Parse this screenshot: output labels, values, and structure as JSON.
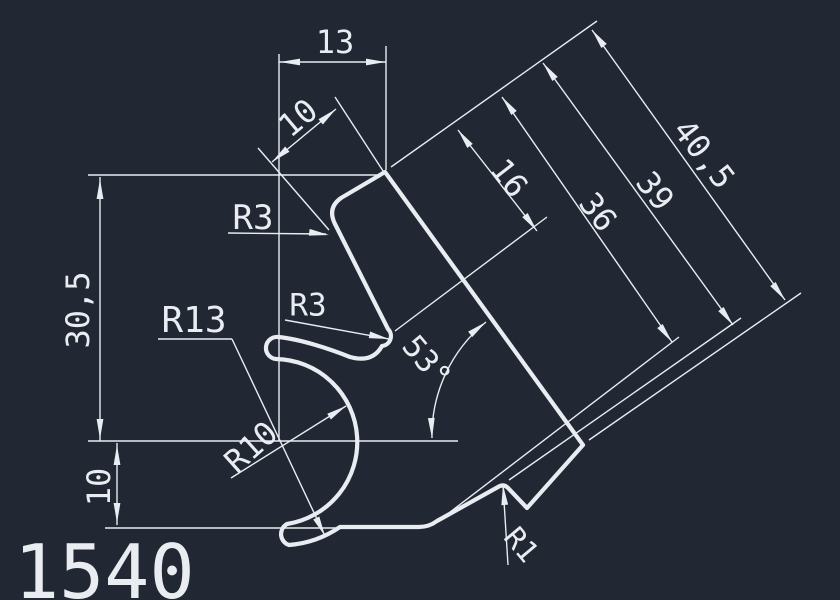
{
  "window": {
    "type": "cad-drawing-viewport",
    "description": "AutoCAD-style technical drawing of profile cross-section on dark model-space background"
  },
  "colors": {
    "background": "#212733",
    "line": "#e9edf2"
  },
  "part": {
    "number": "1540"
  },
  "dimensions": {
    "dim_13": {
      "label": "13"
    },
    "dim_10_top": {
      "label": "10"
    },
    "dim_30_5": {
      "label": "30,5"
    },
    "dim_10_left": {
      "label": "10"
    },
    "dim_16": {
      "label": "16"
    },
    "dim_36": {
      "label": "36"
    },
    "dim_39": {
      "label": "39"
    },
    "dim_40_5": {
      "label": "40,5"
    },
    "angle_53": {
      "label": "53°"
    },
    "radius_r13": {
      "label": "R13"
    },
    "radius_r10": {
      "label": "R10"
    },
    "radius_r3_upper": {
      "label": "R3"
    },
    "radius_r3_lower": {
      "label": "R3"
    },
    "radius_r1": {
      "label": "R1"
    }
  }
}
